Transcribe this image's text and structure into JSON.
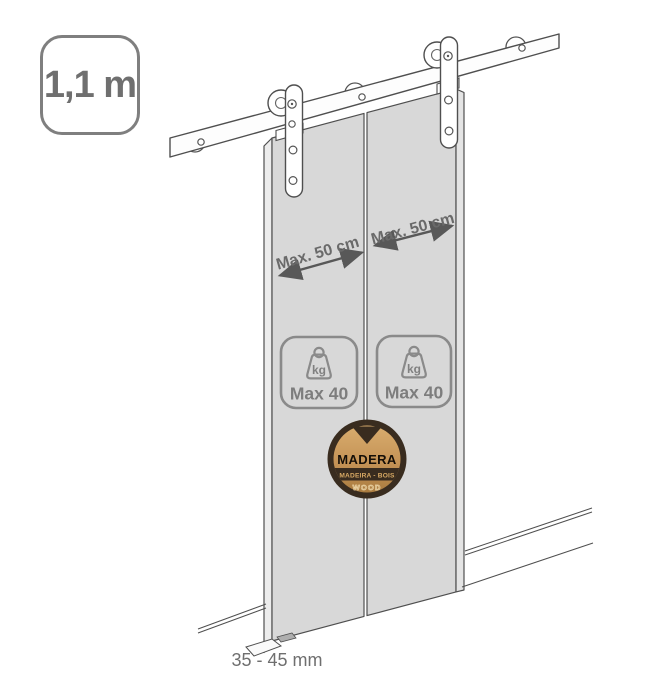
{
  "capacity_badge": {
    "label": "1,1 m"
  },
  "labels": {
    "left_door_width": "Max. 50 cm",
    "right_door_width": "Max. 50 cm",
    "floor_clearance": "35 - 45 mm"
  },
  "weight_badges": {
    "left": {
      "unit": "kg",
      "max_label": "Max 40"
    },
    "right": {
      "unit": "kg",
      "max_label": "Max 40"
    }
  },
  "material_badge": {
    "name": "MADERA",
    "translations": "MADEIRA - BOIS",
    "english": "WOOD"
  },
  "colors": {
    "door_fill": "#d8d8d8",
    "door_edge_fill": "#ececec",
    "line": "#4f4f4f",
    "annotation_text": "#6a6a6a",
    "badge_border": "#7f7f7f",
    "weight_badge_outline": "#8a8a8a",
    "material_ring": "#392c1f",
    "material_wood": "#c99b58"
  }
}
